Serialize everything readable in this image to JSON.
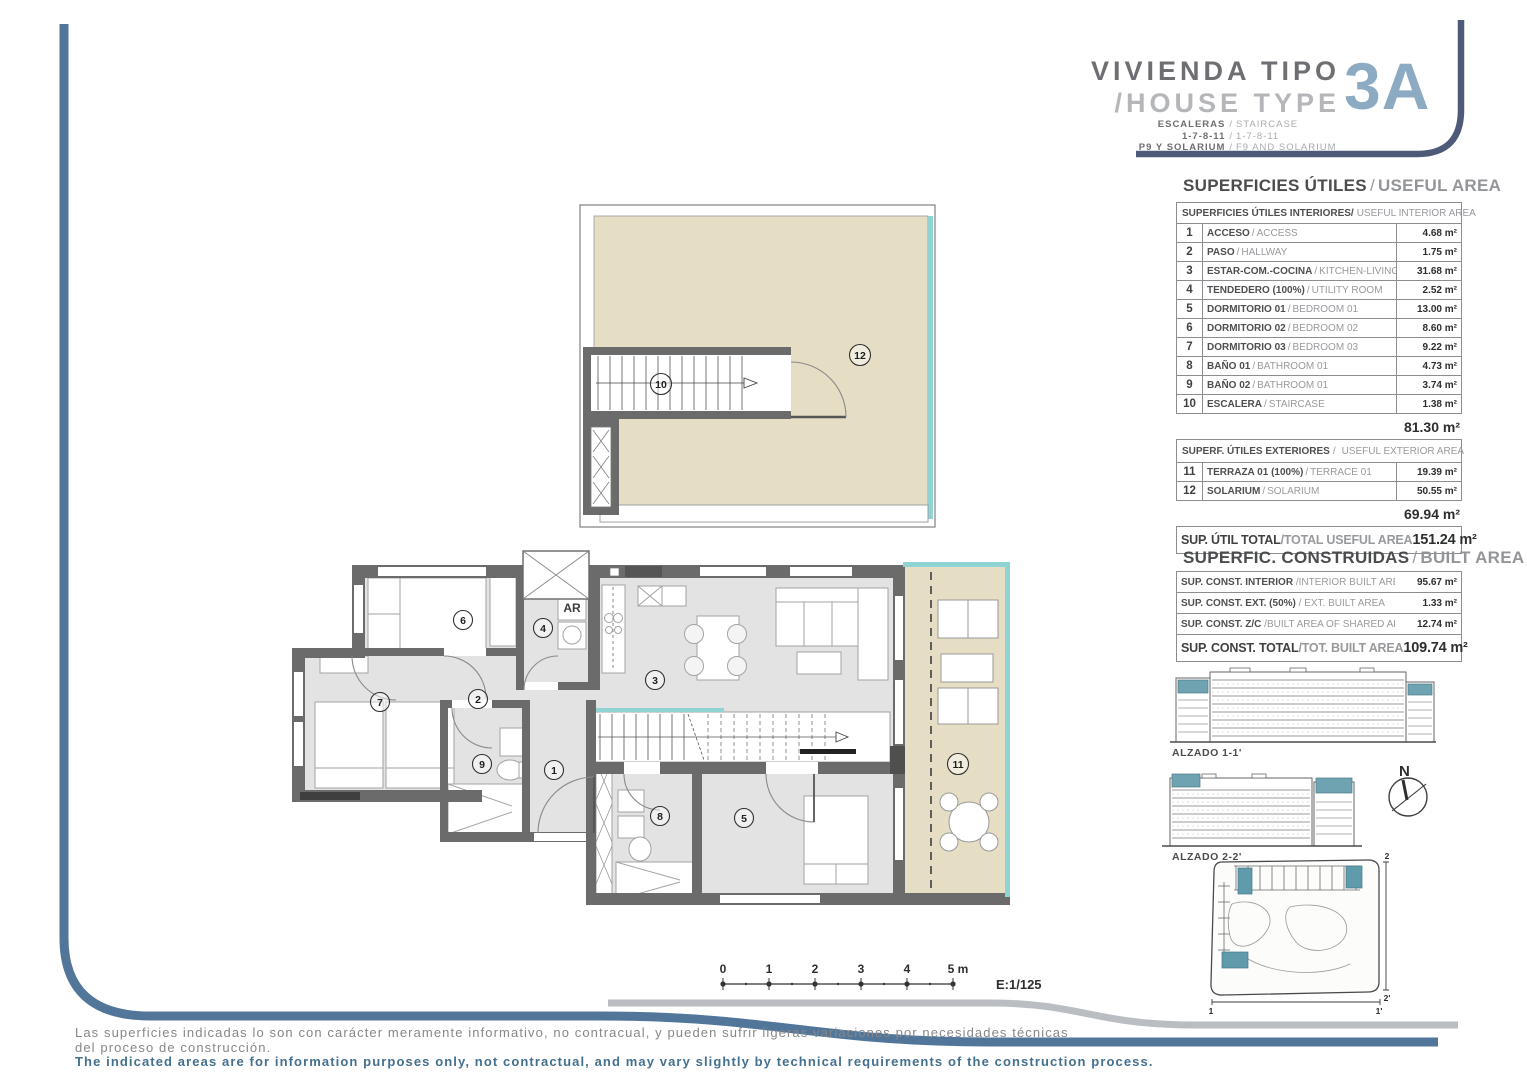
{
  "sep": "/",
  "title_block": {
    "line1": "VIVIENDA TIPO",
    "line2": "/HOUSE TYPE",
    "type_code": "3A",
    "rows": [
      {
        "es": "ESCALERAS",
        "en": "STAIRCASE"
      },
      {
        "es": "1-7-8-11",
        "en": "1-7-8-11"
      },
      {
        "es": "P9 Y SOLARIUM",
        "en": "F9 AND SOLARIUM"
      }
    ]
  },
  "useful_area": {
    "title_es": "SUPERFICIES ÚTILES",
    "title_en": "USEFUL AREA",
    "interior_header_es": "SUPERFICIES ÚTILES INTERIORES/",
    "interior_header_en": "USEFUL INTERIOR AREA",
    "interior_rows": [
      {
        "num": "1",
        "es": "ACCESO",
        "en": "ACCESS",
        "area": "4.68 m²"
      },
      {
        "num": "2",
        "es": "PASO",
        "en": "HALLWAY",
        "area": "1.75 m²"
      },
      {
        "num": "3",
        "es": "ESTAR-COM.-COCINA",
        "en": "KITCHEN-LIVING",
        "area": "31.68 m²"
      },
      {
        "num": "4",
        "es": "TENDEDERO (100%)",
        "en": "UTILITY ROOM",
        "area": "2.52 m²"
      },
      {
        "num": "5",
        "es": "DORMITORIO 01",
        "en": "BEDROOM 01",
        "area": "13.00 m²"
      },
      {
        "num": "6",
        "es": "DORMITORIO 02",
        "en": "BEDROOM 02",
        "area": "8.60 m²"
      },
      {
        "num": "7",
        "es": "DORMITORIO 03",
        "en": "BEDROOM 03",
        "area": "9.22 m²"
      },
      {
        "num": "8",
        "es": "BAÑO 01",
        "en": "BATHROOM 01",
        "area": "4.73 m²"
      },
      {
        "num": "9",
        "es": "BAÑO 02",
        "en": "BATHROOM 01",
        "area": "3.74 m²"
      },
      {
        "num": "10",
        "es": "ESCALERA",
        "en": "STAIRCASE",
        "area": "1.38 m²"
      }
    ],
    "interior_subtotal": "81.30 m²",
    "exterior_header_es": "SUPERF. ÚTILES EXTERIORES",
    "exterior_header_en": "USEFUL EXTERIOR AREA",
    "exterior_rows": [
      {
        "num": "11",
        "es": "TERRAZA 01 (100%)",
        "en": "TERRACE 01",
        "area": "19.39 m²"
      },
      {
        "num": "12",
        "es": "SOLARIUM",
        "en": "SOLARIUM",
        "area": "50.55 m²"
      }
    ],
    "exterior_subtotal": "69.94 m²",
    "total_es": "SUP. ÚTIL TOTAL",
    "total_en": "/TOTAL USEFUL AREA",
    "total_value": "151.24 m²"
  },
  "built_area": {
    "title_es": "SUPERFIC. CONSTRUIDAS",
    "title_en": "BUILT AREA",
    "rows": [
      {
        "es": "SUP. CONST. INTERIOR",
        "en": "/INTERIOR BUILT AREA",
        "value": "95.67 m²"
      },
      {
        "es": "SUP. CONST. EXT. (50%)",
        "en": "/ EXT. BUILT AREA",
        "value": "1.33 m²"
      },
      {
        "es": "SUP. CONST. Z/C",
        "en": "/BUILT AREA OF SHARED AREAS",
        "value": "12.74 m²"
      }
    ],
    "total_es": "SUP. CONST. TOTAL",
    "total_en": "/TOT. BUILT AREA",
    "total_value": "109.74 m²"
  },
  "plan": {
    "labels": [
      "1",
      "2",
      "3",
      "4",
      "5",
      "6",
      "7",
      "8",
      "9",
      "10",
      "11",
      "12"
    ],
    "ar": "AR"
  },
  "elevations": {
    "alzado1": "ALZADO 1-1'",
    "alzado2": "ALZADO 2-2'"
  },
  "compass": {
    "n": "N"
  },
  "site": {
    "top": "2",
    "bottom": "2'",
    "left": "1",
    "right": "1'"
  },
  "scalebar": {
    "ticks": [
      "0",
      "1",
      "2",
      "3",
      "4",
      "5 m"
    ],
    "scale": "E:1/125"
  },
  "disclaimer": {
    "es1": "Las superficies indicadas lo son con carácter meramente informativo, no contracual, y pueden sufrir ligeras variaciones por necesidades técnicas",
    "es2": "del proceso de construcción.",
    "en": "The indicated areas are for information purposes only, not contractual, and may vary slightly by technical requirements of the construction process."
  }
}
